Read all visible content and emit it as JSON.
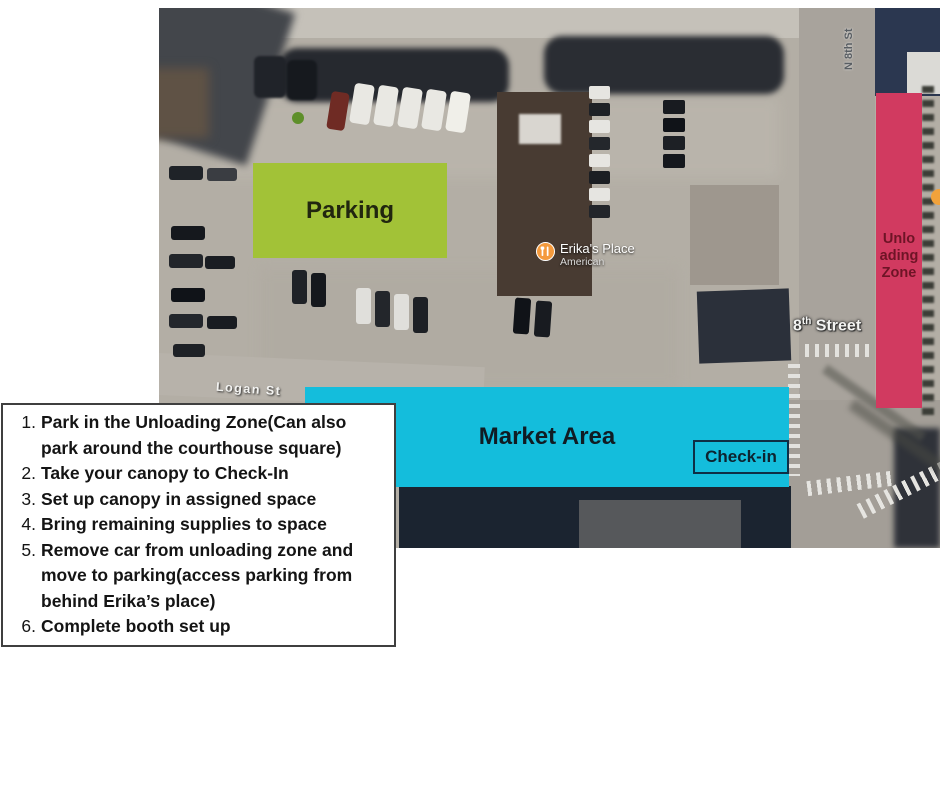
{
  "zones": {
    "parking": "Parking",
    "market": "Market Area",
    "checkin": "Check-in",
    "unloading_lines": [
      "Unlo",
      "ading",
      "Zone"
    ]
  },
  "streets": {
    "eighth_num": "8",
    "eighth_sup": "th",
    "eighth_rest": " Street",
    "logan": "Logan St",
    "n8th": "N 8th St"
  },
  "poi": {
    "name": "Erika's Place",
    "category": "American"
  },
  "instructions": [
    {
      "num": "1.",
      "text": "Park in the Unloading Zone(Can also park around the courthouse square)"
    },
    {
      "num": "2.",
      "text": "Take your canopy to Check-In"
    },
    {
      "num": "3.",
      "text": "Set up canopy in assigned space"
    },
    {
      "num": "4.",
      "text": "Bring remaining supplies to space"
    },
    {
      "num": "5.",
      "text": "Remove car from unloading zone and move to parking(access parking from behind Erika’s place)"
    },
    {
      "num": "6.",
      "text": "Complete booth set up"
    }
  ],
  "colors": {
    "parking_zone": "#a2c237",
    "market_zone": "#14bddc",
    "unloading_zone": "#d13a60",
    "pin_orange": "#f49a3d"
  }
}
